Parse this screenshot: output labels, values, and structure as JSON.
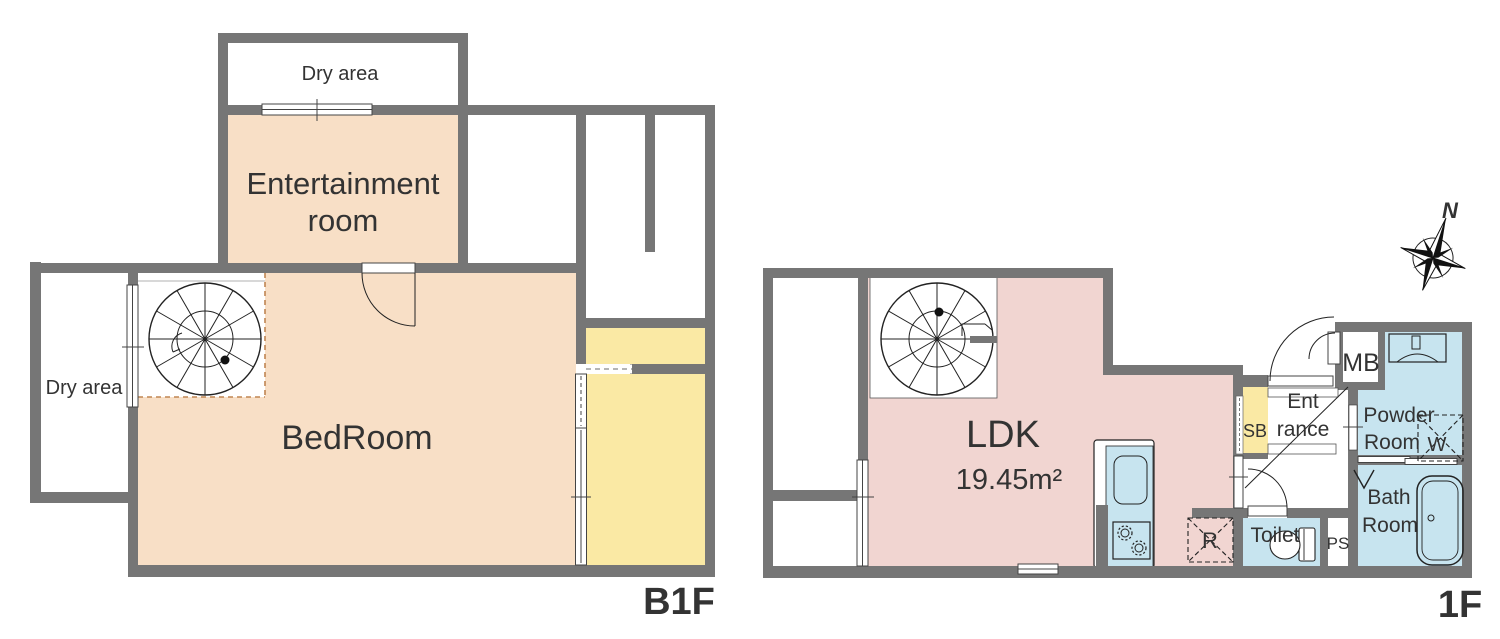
{
  "colors": {
    "bg": "#ffffff",
    "wall": "#767676",
    "room_peach": "#f8dfc6",
    "room_pink": "#f1d5d1",
    "room_yellow": "#fae9a4",
    "room_blue": "#c7e4ef",
    "stair_dash": "#c08552",
    "line": "#222222",
    "text": "#333333"
  },
  "b1f": {
    "floor_label": "B1F",
    "rooms": {
      "dry_area_top": "Dry area",
      "entertainment": {
        "line1": "Entertainment",
        "line2": "room"
      },
      "dry_area_left": "Dry area",
      "bedroom": "BedRoom"
    }
  },
  "f1": {
    "floor_label": "1F",
    "compass_north": "N",
    "rooms": {
      "ldk": {
        "label": "LDK",
        "area": "19.45m²"
      },
      "shoe_box": "SB",
      "entrance": {
        "line1": "Ent",
        "line2": "rance"
      },
      "meter_box": "MB",
      "powder_room": {
        "line1": "Powder",
        "line2": "Room"
      },
      "washing_machine": "W",
      "bath_room": {
        "line1": "Bath",
        "line2": "Room"
      },
      "toilet": "Toilet",
      "pipe_space": "PS",
      "refrigerator": "R"
    }
  }
}
